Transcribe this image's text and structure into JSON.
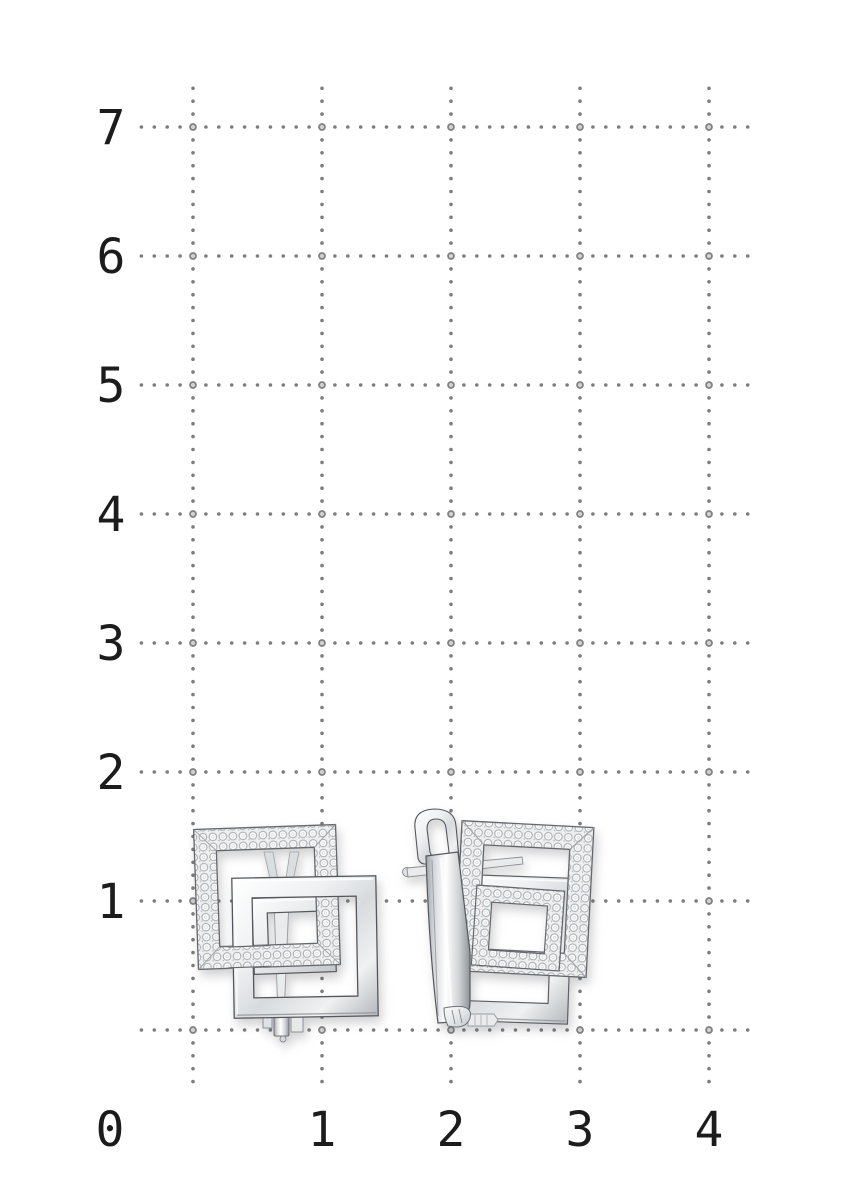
{
  "page": {
    "width": 857,
    "height": 1200,
    "background": "#ffffff"
  },
  "grid": {
    "dot_color": "#7d7d7d",
    "node_fill": "#d0d0d0",
    "node_stroke": "#808080",
    "label_color": "#1c1c1c",
    "dot_spacing": 12.9,
    "dot_radius": 1.8,
    "node_radius": 3.0,
    "node_stroke_width": 1.7,
    "x_lines": [
      193,
      322,
      451,
      580,
      709
    ],
    "y_lines": [
      127,
      256,
      385,
      514,
      643,
      772,
      901,
      1030
    ],
    "h_dots_before": 4,
    "h_dots_after": 3,
    "v_dots_before": 3,
    "v_dots_after": 4,
    "x_axis_labels": [
      {
        "text": "0",
        "x": 110
      },
      {
        "text": "1",
        "x": 322
      },
      {
        "text": "2",
        "x": 451
      },
      {
        "text": "3",
        "x": 580
      },
      {
        "text": "4",
        "x": 709
      }
    ],
    "x_label_baseline": 1146,
    "y_axis_labels": [
      {
        "text": "7",
        "y": 127
      },
      {
        "text": "6",
        "y": 256
      },
      {
        "text": "5",
        "y": 385
      },
      {
        "text": "4",
        "y": 514
      },
      {
        "text": "3",
        "y": 643
      },
      {
        "text": "2",
        "y": 772
      },
      {
        "text": "1",
        "y": 901
      }
    ],
    "y_label_x": 111,
    "y_label_baseline_offset": 17
  },
  "photo": {
    "alt": "Pair of silver earrings with interlocking square frames pave-set with small round stones, left earring shown from the front, right earring shown from the side with english-lock clasp, on a dotted centimeter grid",
    "metal": {
      "light": "#ffffff",
      "mid": "#d8dbde",
      "dark": "#9fa4a8",
      "outline": "#54585c"
    },
    "stones": {
      "base": "#edeff0",
      "rim": "#a4a8ac",
      "sparkle": "#ffffff"
    }
  }
}
